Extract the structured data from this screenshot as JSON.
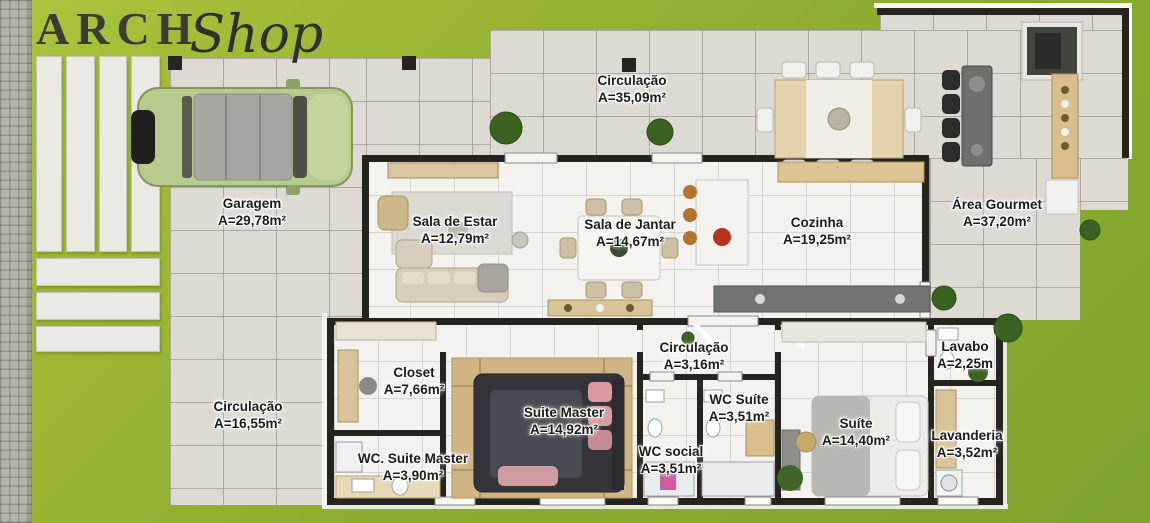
{
  "logo": {
    "part1": "ARCH",
    "part2": "Shop"
  },
  "rooms": [
    {
      "name": "Circulação",
      "area": "A=35,09m²"
    },
    {
      "name": "Garagem",
      "area": "A=29,78m²"
    },
    {
      "name": "Sala de Estar",
      "area": "A=12,79m²"
    },
    {
      "name": "Sala de Jantar",
      "area": "A=14,67m²"
    },
    {
      "name": "Cozinha",
      "area": "A=19,25m²"
    },
    {
      "name": "Área Gourmet",
      "area": "A=37,20m²"
    },
    {
      "name": "Circulação",
      "area": "A=16,55m²"
    },
    {
      "name": "Closet",
      "area": "A=7,66m²"
    },
    {
      "name": "Suite Master",
      "area": "A=14,92m²"
    },
    {
      "name": "WC. Suite Master",
      "area": "A=3,90m²"
    },
    {
      "name": "Circulação",
      "area": "A=3,16m²"
    },
    {
      "name": "WC Suíte",
      "area": "A=3,51m²"
    },
    {
      "name": "WC social",
      "area": "A=3,51m²"
    },
    {
      "name": "Suíte",
      "area": "A=14,40m²"
    },
    {
      "name": "Lavabo",
      "area": "A=2,25m"
    },
    {
      "name": "Lavanderia",
      "area": "A=3,52m²"
    }
  ],
  "colors": {
    "lawn": "#8fae2e",
    "patio_tile": "#dcdad3",
    "indoor_floor": "#f3f2ee",
    "wall": "#26241f",
    "wood": "#d9c49a",
    "label_text": "#1b1b19",
    "car_body": "#b7cb8f"
  }
}
